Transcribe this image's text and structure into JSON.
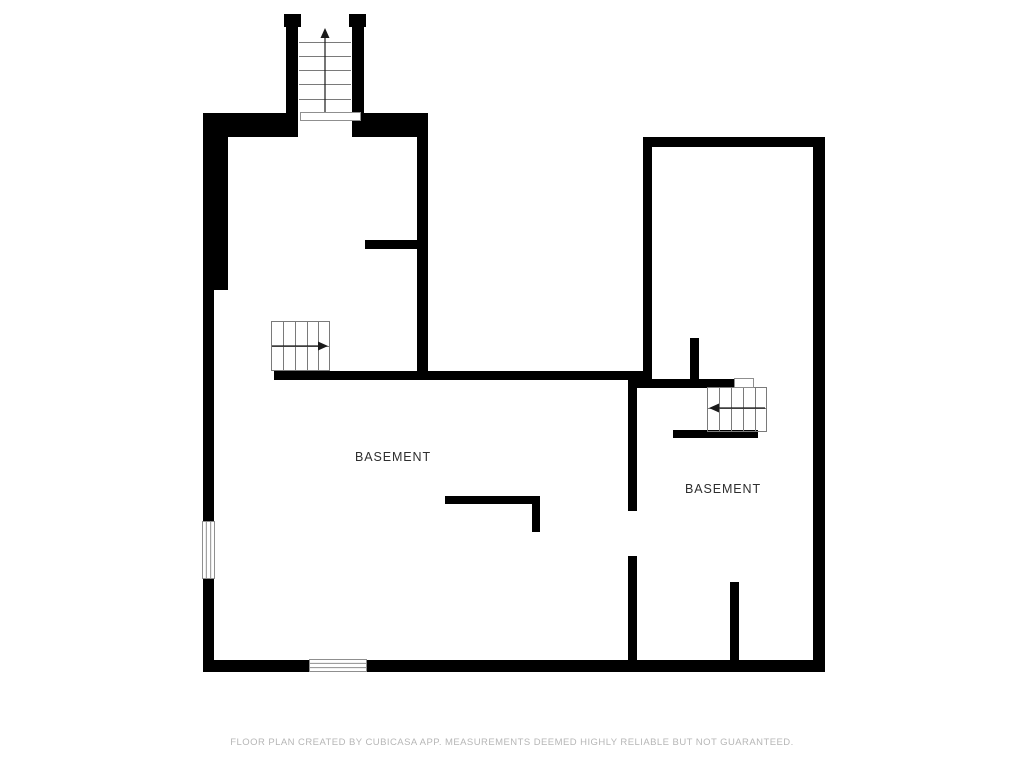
{
  "colors": {
    "background": "#ffffff",
    "wall": "#000000",
    "stair_line": "#7a7a7a",
    "arrow": "#1a1a1a",
    "window_border": "#8f8f8f",
    "room_label": "#2e2e2e",
    "footer_text": "#b6b6b6"
  },
  "plan": {
    "rooms": [
      {
        "label": "BASEMENT",
        "cx": 393,
        "cy": 457
      },
      {
        "label": "BASEMENT",
        "cx": 723,
        "cy": 489
      }
    ],
    "walls": [
      [
        284,
        14,
        17,
        13
      ],
      [
        349,
        14,
        17,
        13
      ],
      [
        286,
        14,
        12,
        101
      ],
      [
        352,
        14,
        12,
        101
      ],
      [
        203,
        113,
        95,
        24
      ],
      [
        352,
        113,
        76,
        24
      ],
      [
        203,
        113,
        25,
        177
      ],
      [
        203,
        290,
        11,
        382
      ],
      [
        417,
        113,
        11,
        258
      ],
      [
        274,
        371,
        378,
        9
      ],
      [
        365,
        240,
        55,
        9
      ],
      [
        643,
        137,
        182,
        10
      ],
      [
        643,
        137,
        9,
        243
      ],
      [
        813,
        137,
        12,
        535
      ],
      [
        203,
        660,
        622,
        12
      ],
      [
        628,
        379,
        9,
        132
      ],
      [
        628,
        556,
        9,
        110
      ],
      [
        636,
        379,
        99,
        9
      ],
      [
        690,
        338,
        9,
        45
      ],
      [
        673,
        430,
        85,
        8
      ],
      [
        730,
        582,
        9,
        84
      ],
      [
        445,
        496,
        95,
        8
      ],
      [
        532,
        496,
        8,
        36
      ]
    ],
    "windows": [
      {
        "name": "left-wall-window",
        "box": [
          202,
          521,
          13,
          58
        ],
        "axis": "v",
        "panes": 2
      },
      {
        "name": "bottom-wall-window",
        "box": [
          309,
          659,
          58,
          13
        ],
        "axis": "h",
        "panes": 2
      },
      {
        "name": "top-stairs-threshold",
        "box": [
          300,
          112,
          61,
          9
        ],
        "axis": "h",
        "panes": 0
      },
      {
        "name": "right-stairs-landing",
        "box": [
          734,
          378,
          20,
          10
        ],
        "axis": "h",
        "panes": 0
      }
    ],
    "stairs": [
      {
        "name": "stairs-up-top",
        "box": [
          298,
          27,
          54,
          88
        ],
        "outline": false,
        "treads": {
          "axis": "h",
          "lines": [
            42,
            56,
            70,
            84,
            99
          ]
        },
        "divider": null,
        "arrow": {
          "x1": 325,
          "y1": 112,
          "x2": 325,
          "y2": 36,
          "dir": "up"
        }
      },
      {
        "name": "stairs-left-room",
        "box": [
          271,
          321,
          59,
          50
        ],
        "outline": true,
        "treads": {
          "axis": "v",
          "lines": [
            283,
            295,
            307,
            318
          ]
        },
        "divider": 346,
        "arrow": {
          "x1": 272,
          "y1": 346,
          "x2": 320,
          "y2": 346,
          "dir": "right"
        }
      },
      {
        "name": "stairs-right-room",
        "box": [
          707,
          387,
          60,
          45
        ],
        "outline": true,
        "treads": {
          "axis": "v",
          "lines": [
            719,
            731,
            743,
            755
          ]
        },
        "divider": 408,
        "arrow": {
          "x1": 765,
          "y1": 408,
          "x2": 717,
          "y2": 408,
          "dir": "left"
        }
      }
    ]
  },
  "footer": {
    "text": "FLOOR PLAN CREATED BY CUBICASA APP. MEASUREMENTS DEEMED HIGHLY RELIABLE BUT NOT GUARANTEED."
  }
}
